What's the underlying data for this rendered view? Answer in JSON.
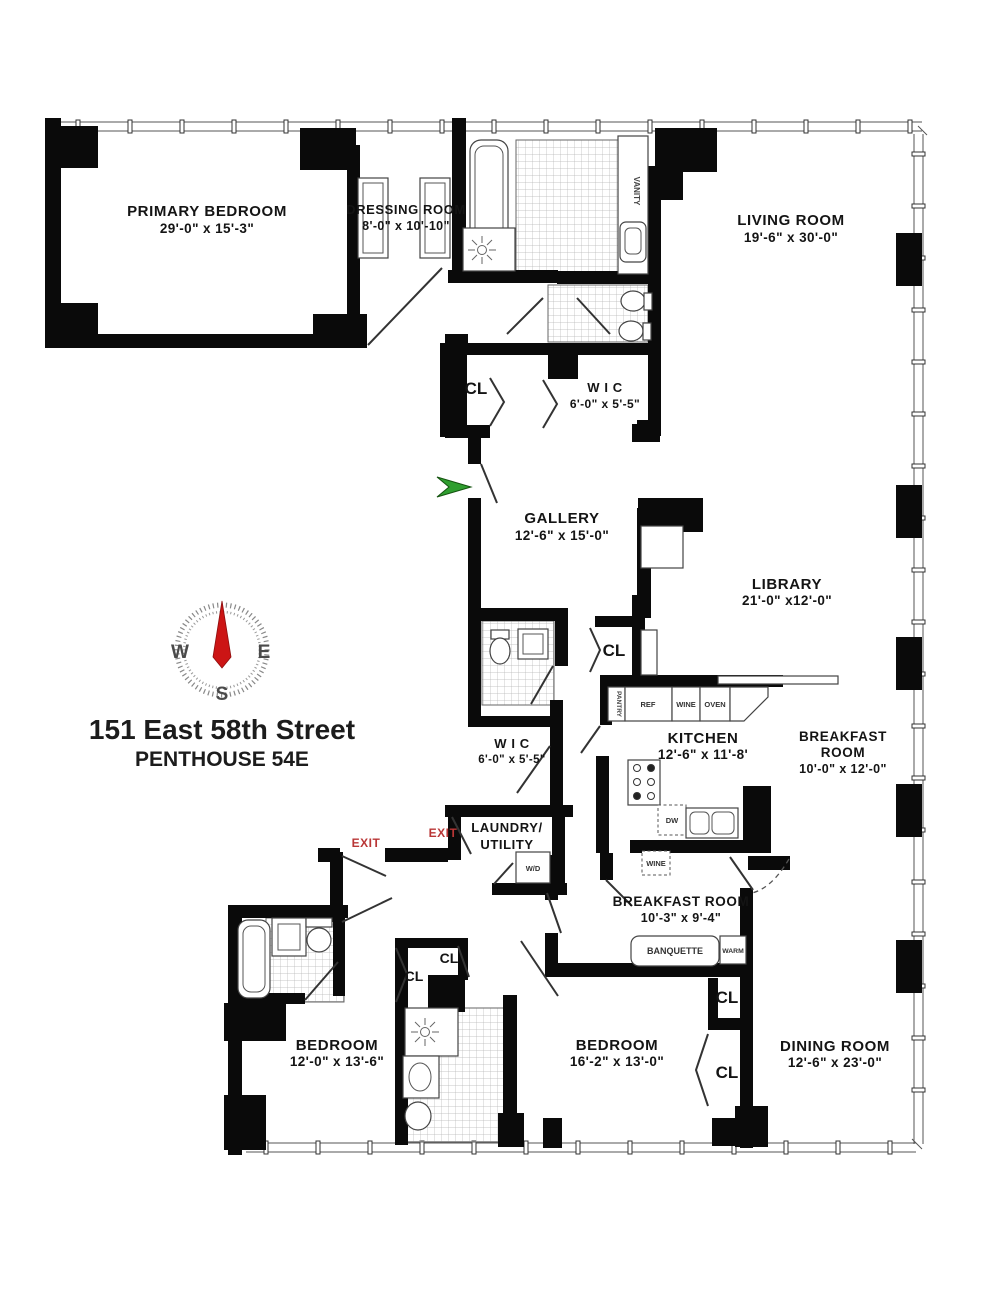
{
  "title": {
    "line1": "151 East 58th Street",
    "line2": "PENTHOUSE 54E"
  },
  "compass": {
    "w": "W",
    "e": "E",
    "s": "S"
  },
  "labels": {
    "cl": "CL",
    "exit": "EXIT"
  },
  "rooms": {
    "primary_bedroom": {
      "name": "PRIMARY BEDROOM",
      "dims": "29'-0\" x 15'-3\""
    },
    "dressing_room": {
      "name": "DRESSING ROOM",
      "dims": "8'-0\" x 10'-10\""
    },
    "living_room": {
      "name": "LIVING ROOM",
      "dims": "19'-6\" x 30'-0\""
    },
    "wic_upper": {
      "name": "W I C",
      "dims": "6'-0\" x 5'-5\""
    },
    "gallery": {
      "name": "GALLERY",
      "dims": "12'-6\" x 15'-0\""
    },
    "library": {
      "name": "LIBRARY",
      "dims": "21'-0\" x12'-0\""
    },
    "wic_lower": {
      "name": "W I C",
      "dims": "6'-0\" x 5'-5\""
    },
    "kitchen": {
      "name": "KITCHEN",
      "dims": "12'-6\" x 11'-8'"
    },
    "breakfast_room_east": {
      "line1": "BREAKFAST",
      "line2": "ROOM",
      "dims": "10'-0\" x 12'-0\""
    },
    "laundry": {
      "line1": "LAUNDRY/",
      "line2": "UTILITY"
    },
    "breakfast_room_south": {
      "name": "BREAKFAST ROOM",
      "dims": "10'-3\" x 9'-4\""
    },
    "bedroom_west": {
      "name": "BEDROOM",
      "dims": "12'-0\" x 13'-6\""
    },
    "bedroom_center": {
      "name": "BEDROOM",
      "dims": "16'-2\" x 13'-0\""
    },
    "dining_room": {
      "name": "DINING ROOM",
      "dims": "12'-6\" x 23'-0\""
    }
  },
  "fixtures": {
    "vanity": "VANITY",
    "pantry": "PANTRY",
    "ref": "REF",
    "wine": "WINE",
    "oven": "OVEN",
    "dw": "DW",
    "wine_cooler": "WINE",
    "wd": "W/D",
    "banquette": "BANQUETTE",
    "warm": "WARM"
  },
  "colors": {
    "wall": "#0a0a0a",
    "exit_red": "#b93636",
    "compass_red": "#cc1515",
    "arrow_green": "#2f9e2f",
    "line": "#444444"
  }
}
